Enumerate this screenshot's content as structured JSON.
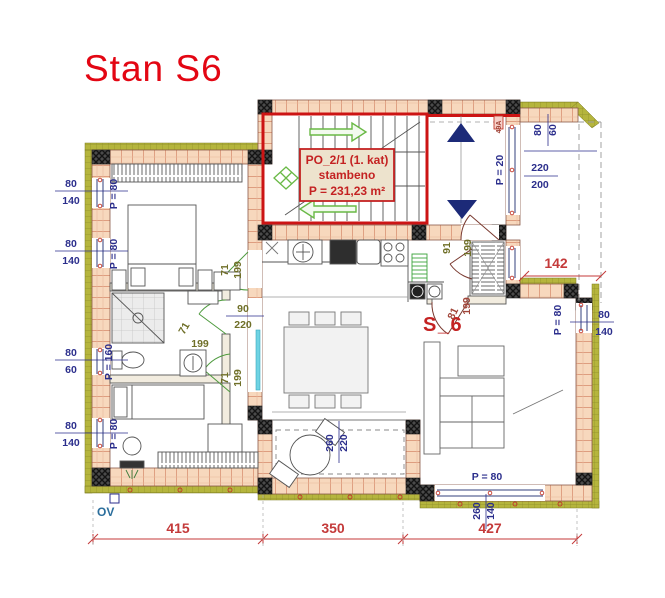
{
  "title": "Stan S6",
  "stairwell_label": {
    "line1": "PO_2/1 (1. kat)",
    "line2": "stambeno",
    "line3": "P = 231,23 m²"
  },
  "apartment_label": "S_6",
  "ov_label": "OV",
  "palette": {
    "title_red": "#e30613",
    "dim_blue": "#2b2e8c",
    "dim_red": "#c43a3a",
    "door_olive": "#6f6f28",
    "door_redbrown": "#a2463a",
    "stair_red": "#cc1414",
    "label_box_bg": "#ede3cd",
    "label_box_border": "#c42222",
    "wall_brick": "#f7d8bd",
    "brick_joint": "#cf7a5a",
    "insulation_green": "#b5b53d",
    "arrow_green": "#69b945",
    "triangle_navy": "#1c2a78",
    "sliding_door_cyan": "#6fd3e3"
  },
  "dimension_labels": [
    {
      "t": "80",
      "x": 71,
      "y": 187
    },
    {
      "t": "140",
      "x": 71,
      "y": 204
    },
    {
      "t": "80",
      "x": 71,
      "y": 247
    },
    {
      "t": "140",
      "x": 71,
      "y": 264
    },
    {
      "t": "80",
      "x": 71,
      "y": 356
    },
    {
      "t": "60",
      "x": 71,
      "y": 373
    },
    {
      "t": "80",
      "x": 71,
      "y": 429
    },
    {
      "t": "140",
      "x": 71,
      "y": 446
    },
    {
      "t": "P = 80",
      "x": 117,
      "y": 194,
      "r": -90
    },
    {
      "t": "P = 80",
      "x": 117,
      "y": 254,
      "r": -90
    },
    {
      "t": "P = 160",
      "x": 112,
      "y": 362,
      "r": -90
    },
    {
      "t": "P = 80",
      "x": 117,
      "y": 434,
      "r": -90
    },
    {
      "t": "80",
      "x": 541,
      "y": 130,
      "r": -90
    },
    {
      "t": "60",
      "x": 556,
      "y": 130,
      "r": -90
    },
    {
      "t": "220",
      "x": 540,
      "y": 171
    },
    {
      "t": "200",
      "x": 540,
      "y": 188
    },
    {
      "t": "P = 20",
      "x": 503,
      "y": 170,
      "r": -90
    },
    {
      "t": "80",
      "x": 604,
      "y": 318
    },
    {
      "t": "140",
      "x": 604,
      "y": 335
    },
    {
      "t": "P = 80",
      "x": 561,
      "y": 320,
      "r": -90
    },
    {
      "t": "P =  80",
      "x": 487,
      "y": 480
    },
    {
      "t": "260",
      "x": 480,
      "y": 511,
      "r": -90
    },
    {
      "t": "140",
      "x": 494,
      "y": 511,
      "r": -90
    },
    {
      "t": "260",
      "x": 333,
      "y": 443,
      "r": -90
    },
    {
      "t": "220",
      "x": 347,
      "y": 443,
      "r": -90
    },
    {
      "t": "90",
      "x": 243,
      "y": 312,
      "c": "door_olive"
    },
    {
      "t": "220",
      "x": 243,
      "y": 328,
      "c": "door_olive"
    },
    {
      "t": "71",
      "x": 228,
      "y": 270,
      "r": -90,
      "c": "door_olive"
    },
    {
      "t": "199",
      "x": 241,
      "y": 270,
      "r": -90,
      "c": "door_olive"
    },
    {
      "t": "71",
      "x": 187,
      "y": 330,
      "r": -60,
      "c": "door_olive"
    },
    {
      "t": "199",
      "x": 200,
      "y": 347,
      "c": "door_olive"
    },
    {
      "t": "71",
      "x": 228,
      "y": 378,
      "r": -90,
      "c": "door_olive"
    },
    {
      "t": "199",
      "x": 241,
      "y": 378,
      "r": -90,
      "c": "door_olive"
    },
    {
      "t": "91",
      "x": 450,
      "y": 248,
      "r": -90,
      "c": "door_olive"
    },
    {
      "t": "199",
      "x": 471,
      "y": 248,
      "r": -90,
      "c": "door_olive"
    },
    {
      "t": "81",
      "x": 456,
      "y": 315,
      "r": -65,
      "c": "door_redbrown"
    },
    {
      "t": "199",
      "x": 470,
      "y": 306,
      "r": -90,
      "c": "door_redbrown"
    },
    {
      "t": "49A",
      "x": 501,
      "y": 127,
      "r": -90,
      "s": 7,
      "c": "door_redbrown"
    },
    {
      "t": "415",
      "x": 178,
      "y": 533,
      "s": 14,
      "c": "dim_red"
    },
    {
      "t": "350",
      "x": 333,
      "y": 533,
      "s": 14,
      "c": "dim_red"
    },
    {
      "t": "427",
      "x": 490,
      "y": 533,
      "s": 14,
      "c": "dim_red"
    },
    {
      "t": "142",
      "x": 556,
      "y": 268,
      "s": 14,
      "c": "dim_red"
    }
  ]
}
